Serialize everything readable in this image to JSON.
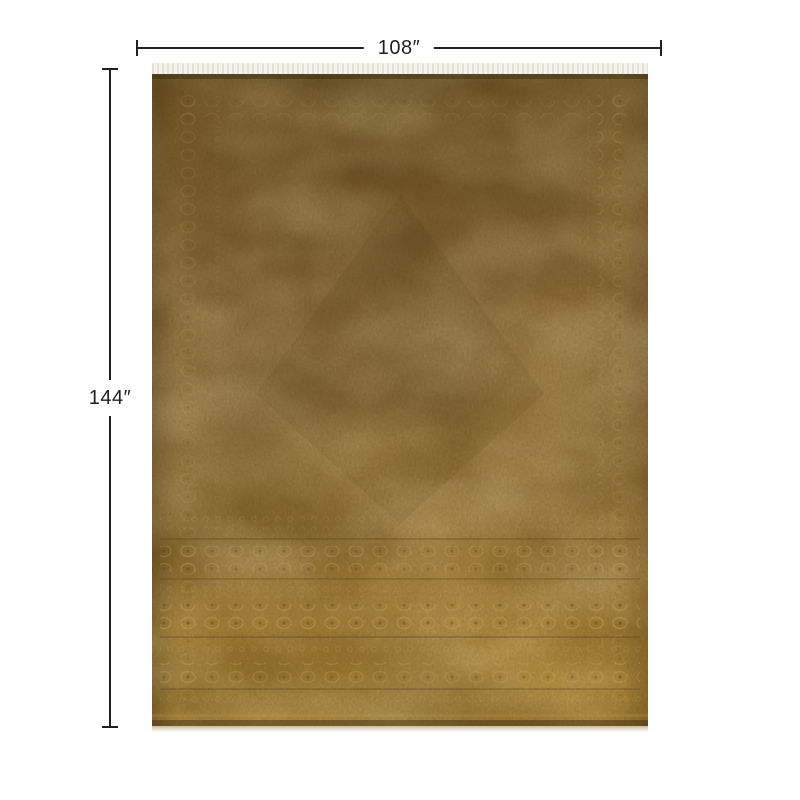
{
  "diagram": {
    "width_label": "108″",
    "height_label": "144″",
    "product": "overdyed-area-rug"
  },
  "colors": {
    "dimension_line": "#231f20",
    "label_text": "#231f20",
    "rug_top": "#6e5426",
    "rug_upper": "#7c5e2c",
    "rug_mid": "#8e6f3e",
    "rug_lower": "#8c6b34",
    "rug_bottom": "#9c782e",
    "fringe_light": "#f6f4ee",
    "fringe_dark": "#e6e1d2"
  }
}
